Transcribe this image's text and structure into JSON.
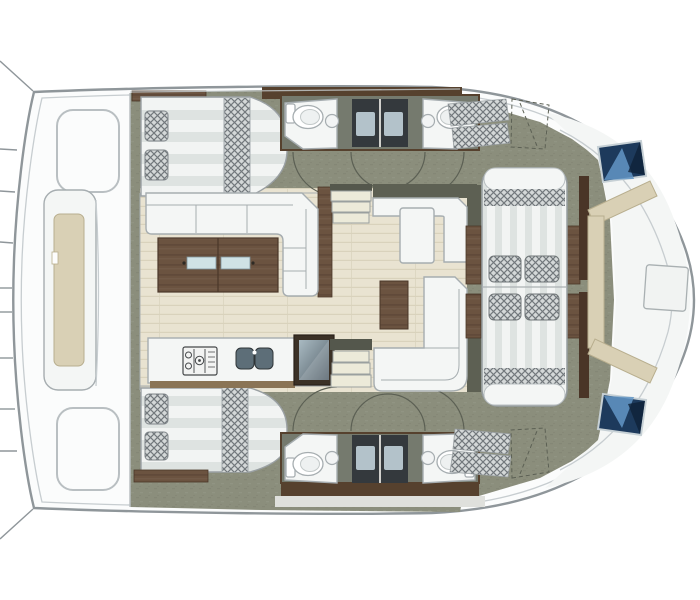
{
  "meta": {
    "title": "catamaran-interior-floor-plan",
    "view": "top-down deck layout rendering",
    "text_present": false
  },
  "palette": {
    "hull_fill": "#fbfcfc",
    "hull_stroke": "#8f969a",
    "inner_line": "#c7cdd0",
    "olive": "#8b8e7c",
    "olive_dark": "#75786a",
    "olive_wall": "#5d6053",
    "plank": "#e9e3d1",
    "plank_line": "#d9d2bc",
    "wood": "#6b5340",
    "wood_dark": "#4a3729",
    "wood_wall": "#56412e",
    "white_f": "#f4f6f5",
    "gray_stroke": "#a6adb0",
    "check_base": "#d4d8d8",
    "check_line": "#72787c",
    "stripe_a": "#f2f4f3",
    "stripe_b": "#dee3e1",
    "beige_cushion": "#d9d0b5",
    "beige_stroke": "#b8ae8e",
    "navy": "#1d3a5c",
    "navy_light": "#6396c5",
    "shower_dark": "#34393d",
    "shower_tray": "#b3c2ca",
    "steel": "#5d6e78",
    "arc_stroke": "#5c6054"
  },
  "inventory": {
    "cabins": [
      "top-hull-double-bed",
      "bottom-hull-double-bed"
    ],
    "bathrooms": [
      "top-head-left",
      "top-head-right",
      "bottom-head-left",
      "bottom-head-right"
    ],
    "bathroom_fixtures": [
      "toilet",
      "washbasin",
      "shower-stall"
    ],
    "saloon": [
      "l-shaped-sofa",
      "wood-coffee-table",
      "galley-counter",
      "stove-icon",
      "double-sink-icon",
      "fridge-unit",
      "chart-counter",
      "chaise-seat",
      "side-wood-table",
      "aft-l-sofa"
    ],
    "circulation": [
      "top-companionway-steps",
      "bottom-companionway-steps",
      "cabin-door-swing-arcs"
    ],
    "cockpit": [
      "large-striped-lounge-pad",
      "checkered-cushions",
      "wood-side-tables"
    ],
    "bow": [
      "beige-seat-backrest",
      "deck-hatch-top",
      "deck-hatch-bottom",
      "deck-table-outline"
    ],
    "stern": [
      "deck-bench-with-cushion",
      "deck-hatch-outlines",
      "platform-seam-lines"
    ]
  }
}
